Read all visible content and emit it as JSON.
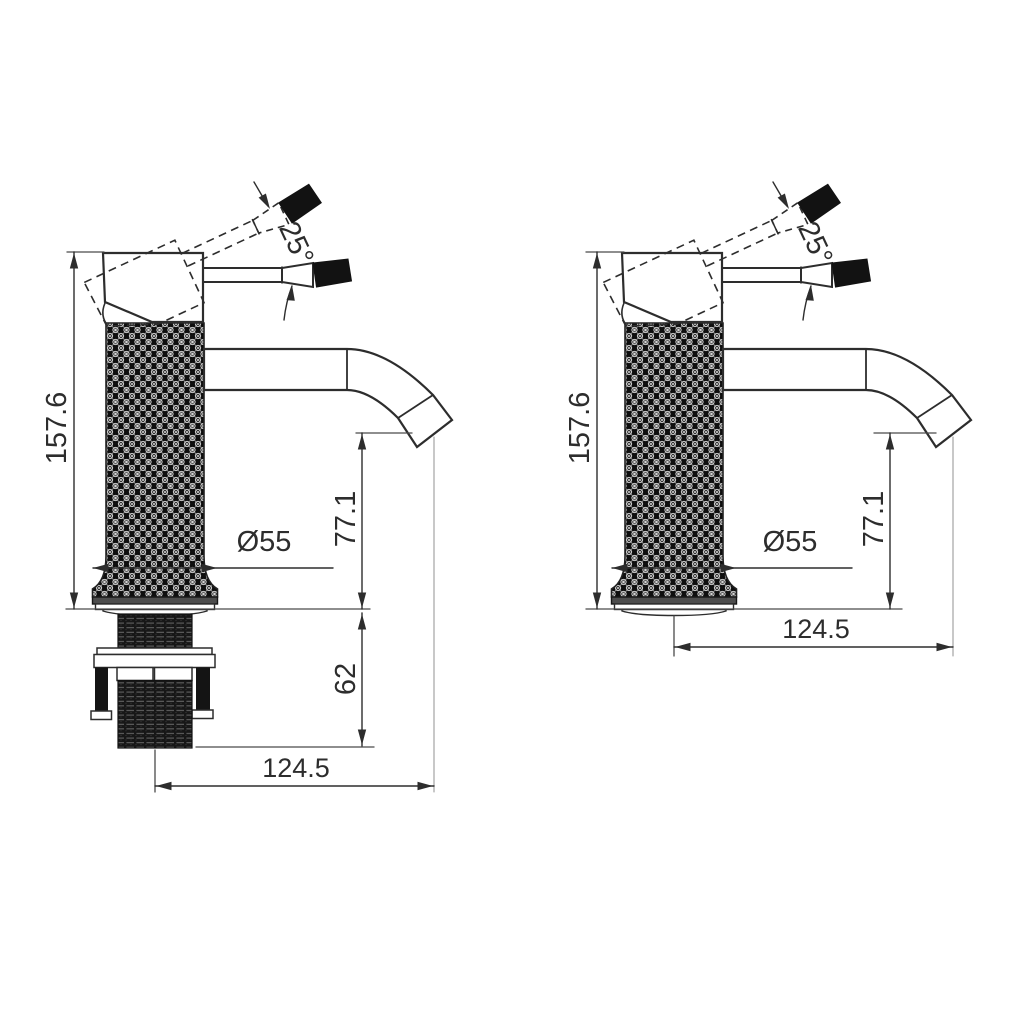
{
  "dimensions": {
    "total_height": "157.6",
    "spout_height": "77.1",
    "under_counter_depth": "62",
    "spout_reach": "124.5",
    "base_diameter": "Ø55",
    "handle_angle": "25°"
  },
  "colors": {
    "line": "#2d2d2d",
    "extension_line": "#4a4a4a",
    "projection_line": "#9a9a9a",
    "fill_dark": "#141414",
    "flange_gray": "#4d4d4d",
    "background": "#ffffff"
  }
}
